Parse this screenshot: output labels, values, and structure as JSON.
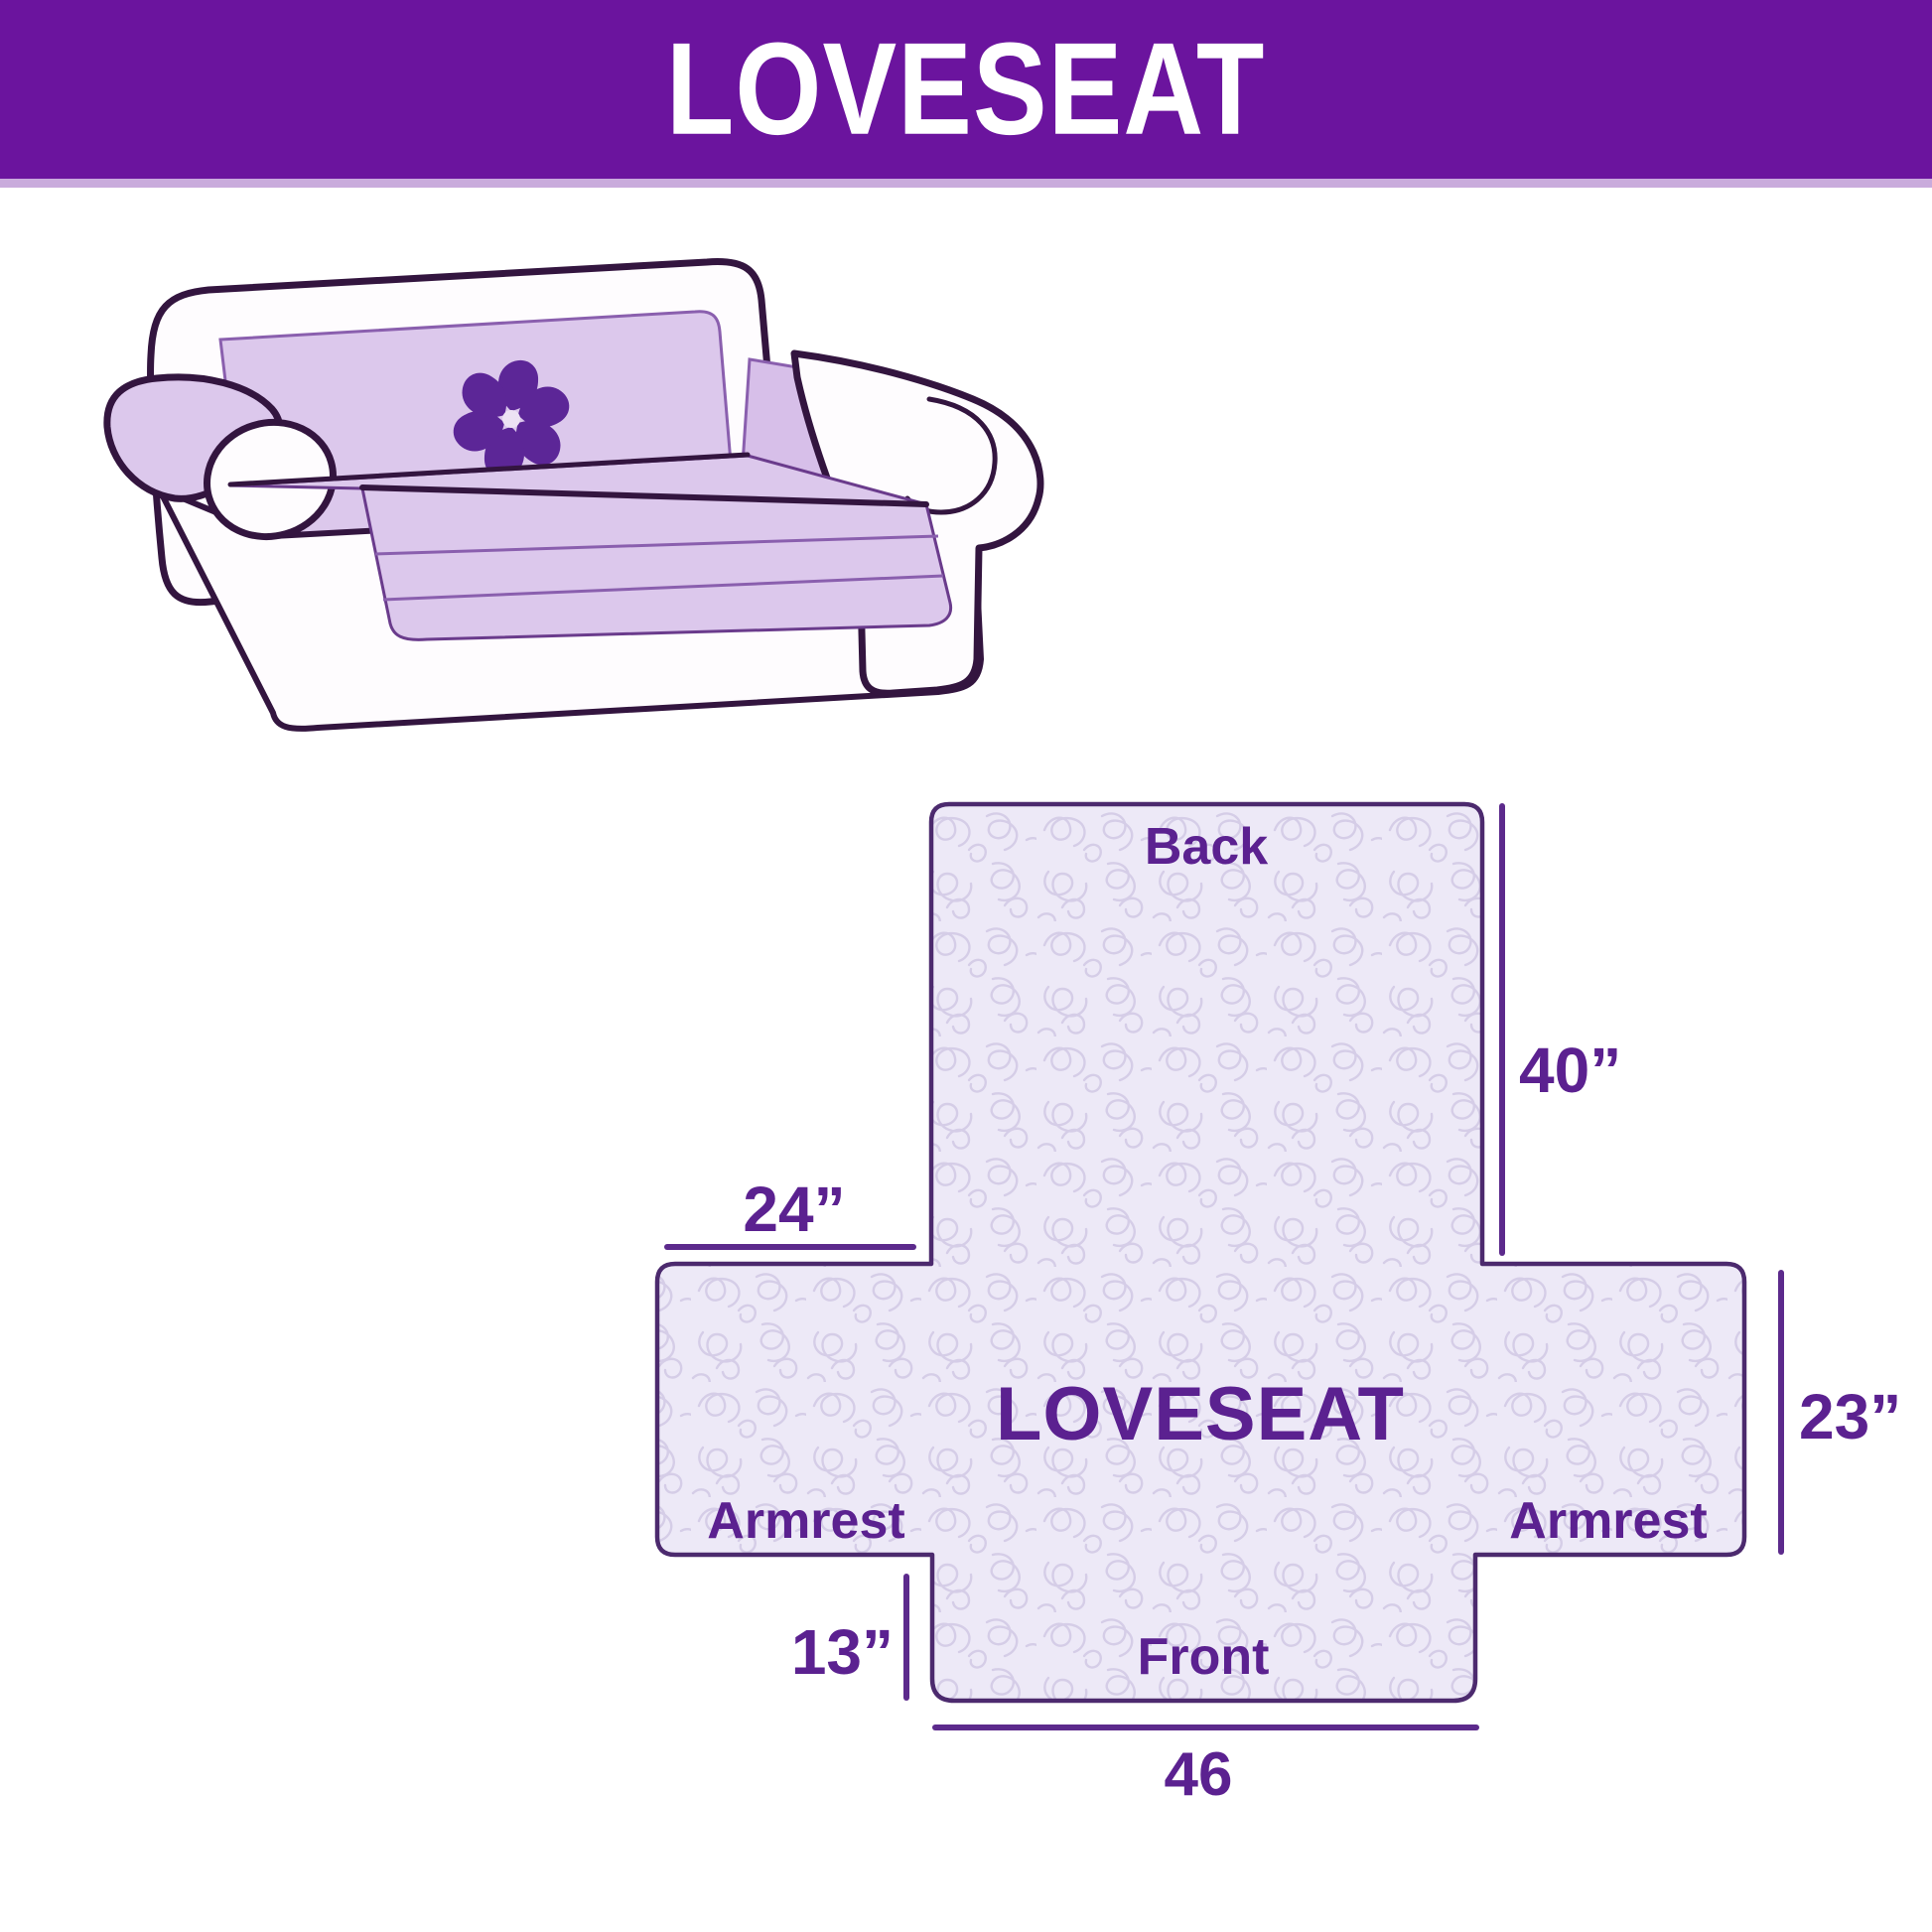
{
  "header": {
    "title": "LOVESEAT",
    "bg_color": "#6B149E",
    "text_color": "#ffffff"
  },
  "illustration": {
    "name": "loveseat-with-slipcover",
    "cover_color": "#DCC8EC",
    "outline_color": "#33153F",
    "logo": "pinwheel",
    "logo_color": "#5C2697"
  },
  "diagram": {
    "center_label": "LOVESEAT",
    "back_label": "Back",
    "front_label": "Front",
    "armrest_left_label": "Armrest",
    "armrest_right_label": "Armrest",
    "dimensions": {
      "back_height": "40”",
      "armrest_top_width": "24”",
      "side_height": "23”",
      "front_skirt_height": "13”",
      "front_width": "46"
    },
    "fill_color": "#EDE9F7",
    "pattern_color": "#D5CDE7",
    "outline_color": "#4C2A6E",
    "label_color": "#5B2190"
  }
}
